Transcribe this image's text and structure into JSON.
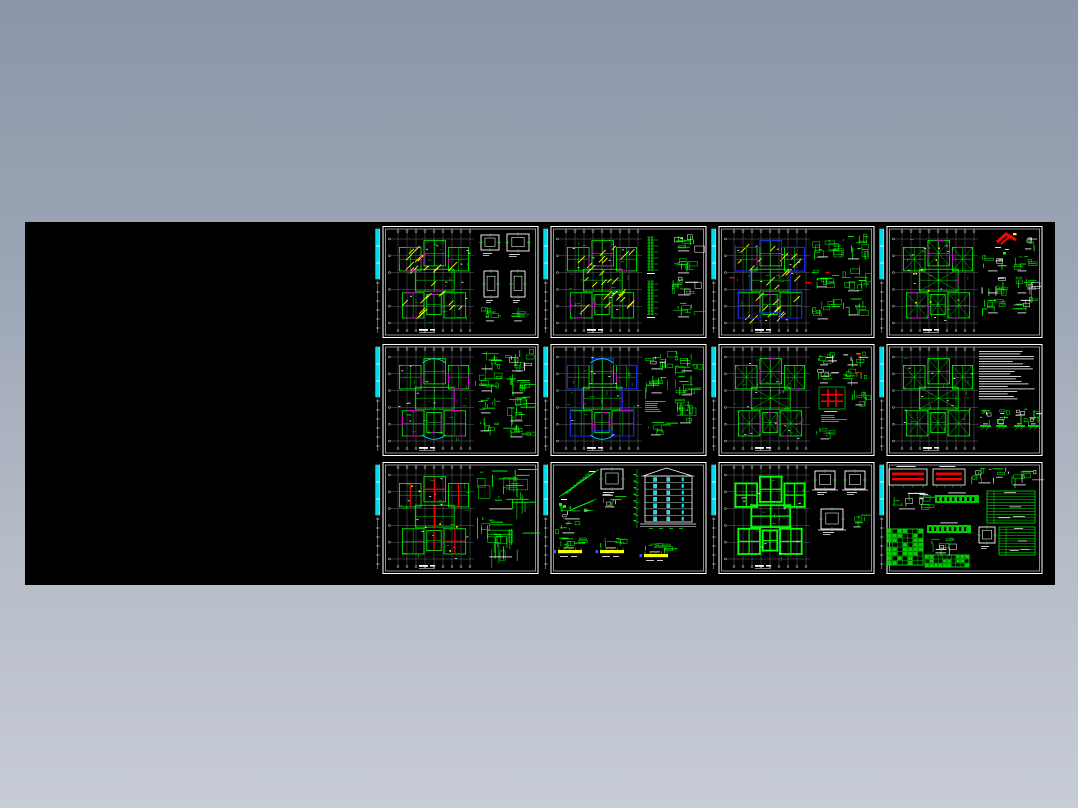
{
  "window": {
    "description": "Preview image of a 12-sheet structural CAD drawing set (4 columns x 3 rows) on a black canvas over a blue-grey gradient backdrop",
    "background_top": "#8b97a9",
    "background_bottom": "#c7ccd6"
  },
  "board": {
    "x": 25,
    "y": 222,
    "w": 1030,
    "h": 363,
    "color": "#000000"
  },
  "grid": {
    "x0": 375,
    "y0": 225,
    "pitch_x": 168,
    "pitch_y": 118,
    "sheet_w": 165,
    "sheet_h": 114,
    "cols": 4,
    "rows": 3
  },
  "palette": {
    "line_green": "#00ff00",
    "hatch_yellow": "#ffff00",
    "accent_magenta": "#d400d4",
    "outline_blue": "#1a1aff",
    "mark_red": "#ff0000",
    "white": "#ffffff",
    "window_cyan": "#00e5ee",
    "strip_cyan": "#00dce8",
    "axis_grey": "#9aa2ab",
    "fill_green": "#00cc00",
    "dot_blue": "#3a5bff"
  },
  "sheets": [
    {
      "name": "sheet-1-floor-framing-plan-with-column-details",
      "components": [
        {
          "t": "plan",
          "x": 23,
          "y": 14,
          "w": 72,
          "h": 84,
          "hatch": true,
          "accent": true
        },
        {
          "t": "title",
          "x": 44,
          "y": 104
        },
        {
          "t": "wbox",
          "x": 106,
          "y": 10,
          "w": 18,
          "h": 15
        },
        {
          "t": "wbox",
          "x": 132,
          "y": 9,
          "w": 22,
          "h": 17
        },
        {
          "t": "wbox",
          "x": 109,
          "y": 46,
          "w": 14,
          "h": 26
        },
        {
          "t": "wbox",
          "x": 136,
          "y": 46,
          "w": 14,
          "h": 26
        },
        {
          "t": "gc",
          "x": 106,
          "y": 82,
          "w": 20,
          "h": 12,
          "d": 8
        },
        {
          "t": "gc",
          "x": 134,
          "y": 82,
          "w": 20,
          "h": 12,
          "d": 8
        }
      ]
    },
    {
      "name": "sheet-2-floor-framing-plan-with-section-details",
      "components": [
        {
          "t": "plan",
          "x": 23,
          "y": 14,
          "w": 72,
          "h": 84,
          "hatch": true,
          "accent": true
        },
        {
          "t": "title",
          "x": 44,
          "y": 104
        },
        {
          "t": "gsec",
          "x": 106,
          "y": 12,
          "h": 34
        },
        {
          "t": "gsec",
          "x": 106,
          "y": 56,
          "h": 34
        },
        {
          "t": "gc",
          "x": 128,
          "y": 8,
          "w": 28,
          "h": 16,
          "d": 12,
          "mix": true
        },
        {
          "t": "gc",
          "x": 128,
          "y": 30,
          "w": 28,
          "h": 16,
          "d": 12
        },
        {
          "t": "gc",
          "x": 128,
          "y": 52,
          "w": 28,
          "h": 16,
          "d": 12,
          "mix": true
        },
        {
          "t": "gc",
          "x": 128,
          "y": 76,
          "w": 28,
          "h": 14,
          "d": 10
        }
      ]
    },
    {
      "name": "sheet-3-floor-framing-plan-blue-outline",
      "components": [
        {
          "t": "plan",
          "x": 23,
          "y": 14,
          "w": 72,
          "h": 84,
          "hatch": true,
          "accent": true,
          "blue": true,
          "red": "marks"
        },
        {
          "t": "title",
          "x": 44,
          "y": 104
        },
        {
          "t": "gc",
          "x": 100,
          "y": 10,
          "w": 26,
          "h": 20,
          "d": 14
        },
        {
          "t": "gc",
          "x": 130,
          "y": 8,
          "w": 28,
          "h": 24,
          "d": 16
        },
        {
          "t": "gc",
          "x": 100,
          "y": 42,
          "w": 24,
          "h": 18,
          "d": 12,
          "red": true
        },
        {
          "t": "gc",
          "x": 130,
          "y": 40,
          "w": 28,
          "h": 24,
          "d": 14
        },
        {
          "t": "gc",
          "x": 100,
          "y": 74,
          "w": 26,
          "h": 18,
          "d": 12
        },
        {
          "t": "gc",
          "x": 132,
          "y": 74,
          "w": 24,
          "h": 14,
          "d": 10
        }
      ]
    },
    {
      "name": "sheet-4-roof-framing-plan-with-red-gable-detail",
      "components": [
        {
          "t": "plan",
          "x": 23,
          "y": 14,
          "w": 72,
          "h": 84,
          "diag": true,
          "dots": true,
          "accent": true
        },
        {
          "t": "title",
          "x": 44,
          "y": 104
        },
        {
          "t": "gable",
          "x": 118,
          "y": 6
        },
        {
          "t": "gc",
          "x": 142,
          "y": 10,
          "w": 16,
          "h": 12,
          "d": 8,
          "mix": true
        },
        {
          "t": "gc",
          "x": 103,
          "y": 30,
          "w": 24,
          "h": 14,
          "d": 10,
          "mix": true
        },
        {
          "t": "gc",
          "x": 133,
          "y": 30,
          "w": 22,
          "h": 14,
          "d": 10
        },
        {
          "t": "gc",
          "x": 103,
          "y": 50,
          "w": 24,
          "h": 16,
          "d": 12,
          "mix": true
        },
        {
          "t": "gc",
          "x": 133,
          "y": 50,
          "w": 22,
          "h": 16,
          "d": 12,
          "mix": true
        },
        {
          "t": "gc",
          "x": 103,
          "y": 72,
          "w": 24,
          "h": 14,
          "d": 10
        },
        {
          "t": "gc",
          "x": 133,
          "y": 72,
          "w": 22,
          "h": 14,
          "d": 10,
          "mix": true
        }
      ]
    },
    {
      "name": "sheet-5-beam-layout-plan-magenta",
      "components": [
        {
          "t": "plan",
          "x": 23,
          "y": 14,
          "w": 72,
          "h": 84,
          "accent": "strong",
          "cyanarc": true
        },
        {
          "t": "title",
          "x": 44,
          "y": 104
        },
        {
          "t": "gc",
          "x": 100,
          "y": 8,
          "w": 26,
          "h": 16,
          "d": 12
        },
        {
          "t": "gc",
          "x": 130,
          "y": 6,
          "w": 28,
          "h": 20,
          "d": 14,
          "mix": true
        },
        {
          "t": "gc",
          "x": 100,
          "y": 30,
          "w": 26,
          "h": 16,
          "d": 12
        },
        {
          "t": "gc",
          "x": 130,
          "y": 30,
          "w": 28,
          "h": 18,
          "d": 14
        },
        {
          "t": "gc",
          "x": 100,
          "y": 54,
          "w": 24,
          "h": 14,
          "d": 10
        },
        {
          "t": "gc",
          "x": 128,
          "y": 54,
          "w": 30,
          "h": 22,
          "d": 18
        },
        {
          "t": "gc",
          "x": 100,
          "y": 74,
          "w": 22,
          "h": 12,
          "d": 8
        },
        {
          "t": "gc",
          "x": 128,
          "y": 80,
          "w": 30,
          "h": 12,
          "d": 10
        }
      ]
    },
    {
      "name": "sheet-6-beam-layout-plan-blue-outline",
      "components": [
        {
          "t": "plan",
          "x": 23,
          "y": 14,
          "w": 72,
          "h": 84,
          "accent": "strong",
          "blue": true,
          "cyanarc": true
        },
        {
          "t": "title",
          "x": 44,
          "y": 104
        },
        {
          "t": "gc",
          "x": 102,
          "y": 8,
          "w": 26,
          "h": 16,
          "d": 12,
          "mix": true
        },
        {
          "t": "gc",
          "x": 132,
          "y": 8,
          "w": 26,
          "h": 18,
          "d": 14
        },
        {
          "t": "gc",
          "x": 102,
          "y": 30,
          "w": 26,
          "h": 18,
          "d": 14
        },
        {
          "t": "gc",
          "x": 132,
          "y": 32,
          "w": 26,
          "h": 18,
          "d": 14
        },
        {
          "t": "gtext",
          "x": 102,
          "y": 58,
          "w": 22,
          "h": 12,
          "n": 6
        },
        {
          "t": "gc",
          "x": 130,
          "y": 56,
          "w": 28,
          "h": 22,
          "d": 16
        },
        {
          "t": "gc",
          "x": 102,
          "y": 78,
          "w": 24,
          "h": 12,
          "d": 8
        }
      ]
    },
    {
      "name": "sheet-7-roof-plan-with-red-grid-detail",
      "components": [
        {
          "t": "plan",
          "x": 23,
          "y": 14,
          "w": 72,
          "h": 84,
          "diag": true,
          "accent": true
        },
        {
          "t": "title",
          "x": 44,
          "y": 104
        },
        {
          "t": "gc",
          "x": 104,
          "y": 8,
          "w": 20,
          "h": 12,
          "d": 9,
          "mix": true
        },
        {
          "t": "gc",
          "x": 130,
          "y": 8,
          "w": 26,
          "h": 12,
          "d": 10,
          "mix": true,
          "red": true
        },
        {
          "t": "gc",
          "x": 104,
          "y": 26,
          "w": 20,
          "h": 12,
          "d": 9,
          "mix": true
        },
        {
          "t": "gc",
          "x": 130,
          "y": 26,
          "w": 26,
          "h": 12,
          "d": 10,
          "red": true
        },
        {
          "t": "redcross",
          "x": 108,
          "y": 44,
          "w": 26,
          "h": 22
        },
        {
          "t": "gc",
          "x": 140,
          "y": 46,
          "w": 18,
          "h": 14,
          "d": 10
        },
        {
          "t": "gtext",
          "x": 110,
          "y": 72,
          "w": 26,
          "h": 8,
          "n": 4
        },
        {
          "t": "gc",
          "x": 104,
          "y": 84,
          "w": 22,
          "h": 10,
          "d": 8
        }
      ]
    },
    {
      "name": "sheet-8-roof-plan-with-general-notes",
      "components": [
        {
          "t": "plan",
          "x": 23,
          "y": 14,
          "w": 72,
          "h": 84,
          "diag": true
        },
        {
          "t": "title",
          "x": 44,
          "y": 104
        },
        {
          "t": "notes",
          "x": 100,
          "y": 8,
          "w": 57,
          "h": 50,
          "n": 20
        },
        {
          "t": "pier",
          "x": 101,
          "y": 66
        },
        {
          "t": "pier",
          "x": 117,
          "y": 66
        },
        {
          "t": "pier",
          "x": 135,
          "y": 66
        },
        {
          "t": "pier",
          "x": 149,
          "y": 66
        }
      ]
    },
    {
      "name": "sheet-9-framing-plan-red-beams",
      "components": [
        {
          "t": "plan",
          "x": 23,
          "y": 14,
          "w": 72,
          "h": 84,
          "red": "beams",
          "dots": true
        },
        {
          "t": "title",
          "x": 44,
          "y": 104
        },
        {
          "t": "gc",
          "x": 100,
          "y": 8,
          "w": 57,
          "h": 38,
          "d": 26
        },
        {
          "t": "gc",
          "x": 100,
          "y": 54,
          "w": 57,
          "h": 40,
          "d": 26
        }
      ]
    },
    {
      "name": "sheet-10-stair-details-and-elevation",
      "components": [
        {
          "t": "stair",
          "x": 16,
          "y": 8
        },
        {
          "t": "wbox",
          "x": 58,
          "y": 8,
          "w": 22,
          "h": 20
        },
        {
          "t": "gc",
          "x": 56,
          "y": 34,
          "w": 24,
          "h": 10,
          "d": 8,
          "mix": true
        },
        {
          "t": "elev",
          "x": 100,
          "y": 6,
          "w": 56,
          "h": 68
        },
        {
          "t": "gc",
          "x": 12,
          "y": 44,
          "w": 38,
          "h": 12,
          "d": 12,
          "mix": true
        },
        {
          "t": "gc",
          "x": 12,
          "y": 60,
          "w": 30,
          "h": 10,
          "d": 8
        },
        {
          "t": "ybeam",
          "x": 14,
          "y": 76
        },
        {
          "t": "ybeam",
          "x": 56,
          "y": 76
        },
        {
          "t": "ybeam",
          "x": 100,
          "y": 80
        }
      ]
    },
    {
      "name": "sheet-11-foundation-plan",
      "components": [
        {
          "t": "plan",
          "x": 23,
          "y": 14,
          "w": 72,
          "h": 84,
          "found": true
        },
        {
          "t": "title",
          "x": 44,
          "y": 104
        },
        {
          "t": "wbox",
          "x": 104,
          "y": 10,
          "w": 20,
          "h": 18,
          "found": true
        },
        {
          "t": "wbox",
          "x": 134,
          "y": 10,
          "w": 20,
          "h": 18,
          "found": true
        },
        {
          "t": "wbox",
          "x": 110,
          "y": 48,
          "w": 22,
          "h": 20,
          "found": true
        },
        {
          "t": "gc",
          "x": 138,
          "y": 54,
          "w": 18,
          "h": 10,
          "d": 6
        }
      ]
    },
    {
      "name": "sheet-12-member-details-and-schedules",
      "components": [
        {
          "t": "redbeam",
          "x": 10,
          "y": 8,
          "w": 38,
          "h": 16
        },
        {
          "t": "redbeam",
          "x": 54,
          "y": 8,
          "w": 32,
          "h": 16
        },
        {
          "t": "gc",
          "x": 92,
          "y": 6,
          "w": 30,
          "h": 14,
          "d": 14,
          "mix": true
        },
        {
          "t": "gc",
          "x": 126,
          "y": 6,
          "w": 32,
          "h": 16,
          "d": 14,
          "mix": true
        },
        {
          "t": "gc",
          "x": 10,
          "y": 32,
          "w": 40,
          "h": 14,
          "d": 16,
          "mix": true
        },
        {
          "t": "gbeam",
          "x": 56,
          "y": 34,
          "w": 44,
          "h": 8
        },
        {
          "t": "gtable",
          "x": 108,
          "y": 30,
          "w": 48,
          "h": 32,
          "n": 11
        },
        {
          "t": "sched",
          "x": 8,
          "y": 68,
          "w": 36,
          "h": 36,
          "r": 8,
          "c": 7
        },
        {
          "t": "gbeam",
          "x": 48,
          "y": 64,
          "w": 44,
          "h": 8
        },
        {
          "t": "gc",
          "x": 50,
          "y": 76,
          "w": 26,
          "h": 14,
          "d": 12,
          "mix": true
        },
        {
          "t": "wbox",
          "x": 100,
          "y": 66,
          "w": 16,
          "h": 16
        },
        {
          "t": "gtable",
          "x": 120,
          "y": 66,
          "w": 36,
          "h": 28,
          "n": 10
        },
        {
          "t": "sched",
          "x": 46,
          "y": 94,
          "w": 44,
          "h": 12,
          "r": 3,
          "c": 10
        }
      ]
    }
  ]
}
